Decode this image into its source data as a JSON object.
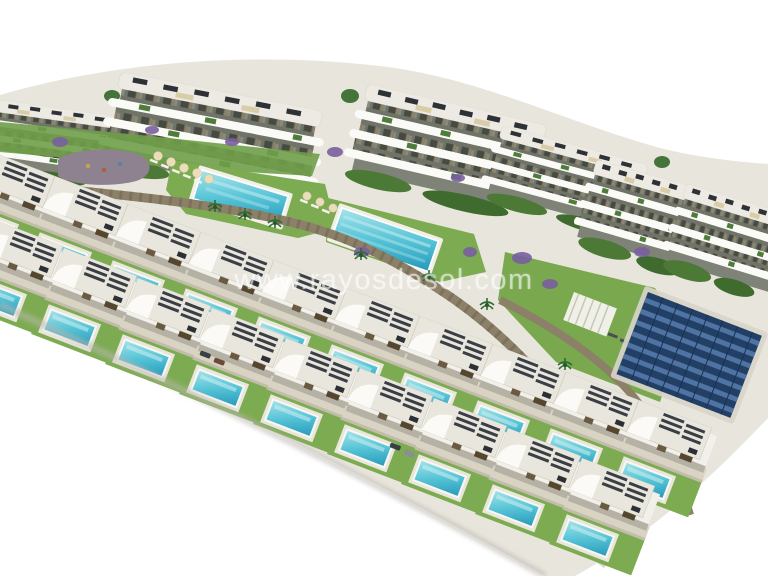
{
  "watermark": {
    "text": "www.rayosdesol.com",
    "color": "rgba(255,255,255,0.55)"
  },
  "scene": {
    "description": "Aerial 3D architect render of a coastal residential development: a diagonal band of white apartment blocks with curved balconies, two long communal pools with sun loungers, stone retaining walls, a solar-panel field, and two staggered rows of modern white villas each with a private turquoise pool, on a pure white background.",
    "apartment_building_count": 6,
    "communal_pool_count": 2,
    "villa_rows": 2
  },
  "palette": {
    "background": "#ffffff",
    "ground": "#e8e5dc",
    "building_white": "#f2f0ea",
    "balcony_white": "#fafaf7",
    "facade_shadow": "#6f7368",
    "roof_light": "#eceae3",
    "roof_slat_dark": "#3a3f45",
    "terrace_beige": "#d9d3c4",
    "lawn_green": "#7dab52",
    "dark_foliage": "#4c7a36",
    "pool_light": "#a7e4ea",
    "pool_mid": "#56c4d6",
    "pool_deep": "#2699bb",
    "stone_wall": "#8d8069",
    "road_gray": "#d9d5cb",
    "solar_blue": "#223f66",
    "solar_stripe": "#4f73a2",
    "purple_flora": "#7a5fa0",
    "parasol_cream": "#e9ddba",
    "playground_taupe": "#8e8290",
    "car_dark": "#3a3f46"
  }
}
